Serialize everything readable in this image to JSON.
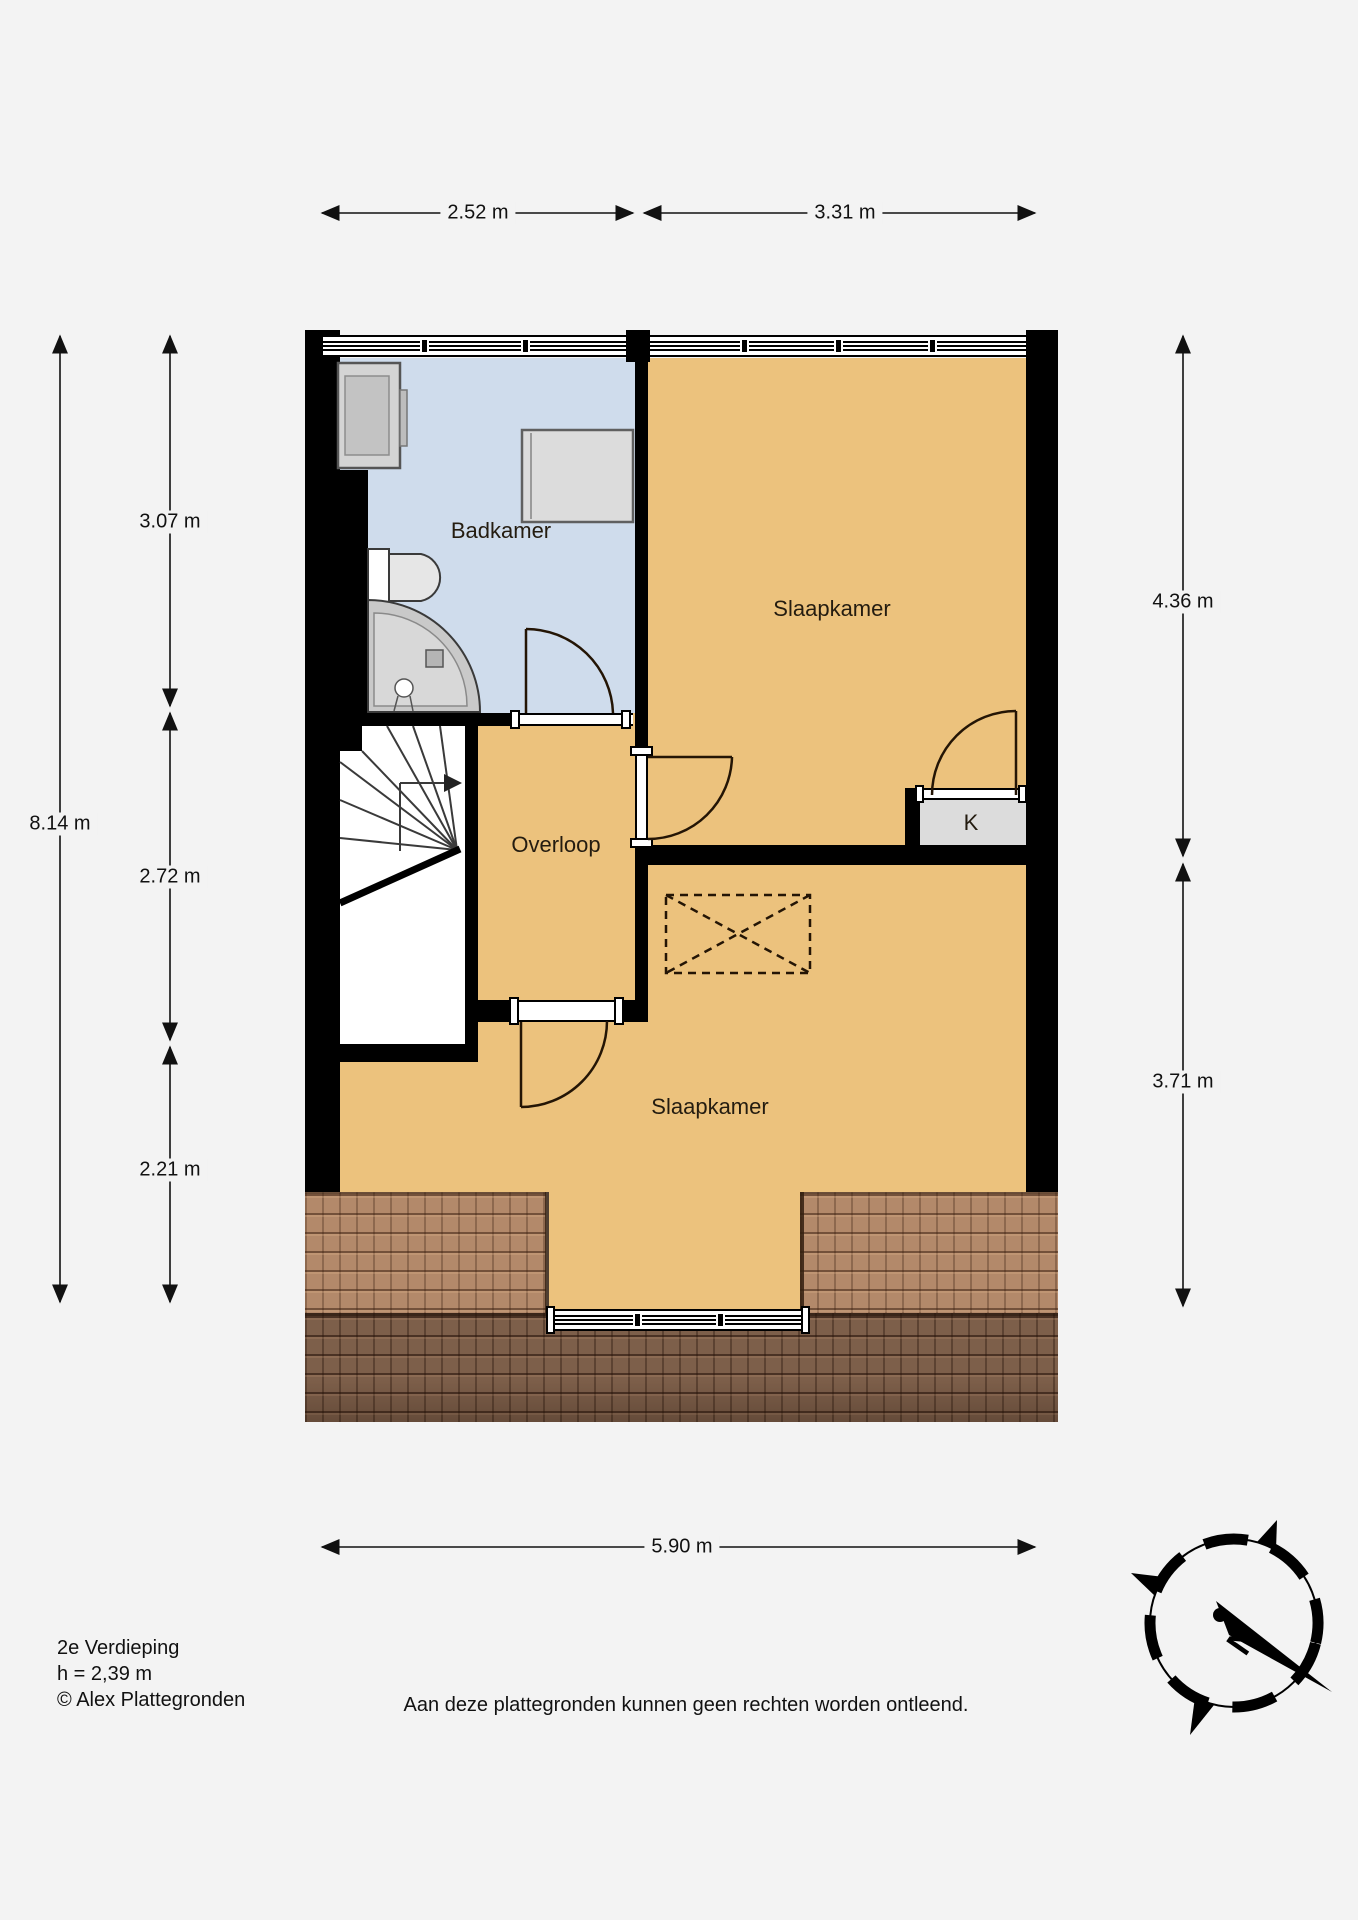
{
  "dimensions": {
    "top": [
      "2.52 m",
      "3.31 m"
    ],
    "left_total": "8.14 m",
    "left_segments": [
      "3.07 m",
      "2.72 m",
      "2.21 m"
    ],
    "right_segments": [
      "4.36 m",
      "3.71 m"
    ],
    "bottom": "5.90 m"
  },
  "rooms": {
    "badkamer": "Badkamer",
    "slaapkamer_top": "Slaapkamer",
    "overloop": "Overloop",
    "slaapkamer_bottom": "Slaapkamer",
    "kast": "K"
  },
  "compass": {
    "north_label": "N"
  },
  "footer": {
    "floor": "2e Verdieping",
    "ceiling_height": "h = 2,39 m",
    "copyright": "© Alex Plattegronden",
    "disclaimer": "Aan deze plattegronden kunnen geen rechten worden ontleend."
  },
  "colors": {
    "room_orange": "#ecc27d",
    "room_blue": "#cfdcec",
    "wall_black": "#000000",
    "fixture_gray": "#d9d9d9",
    "roof_light": "#b3896a",
    "roof_dark": "#7d5f4a",
    "stairwell_white": "#ffffff"
  }
}
